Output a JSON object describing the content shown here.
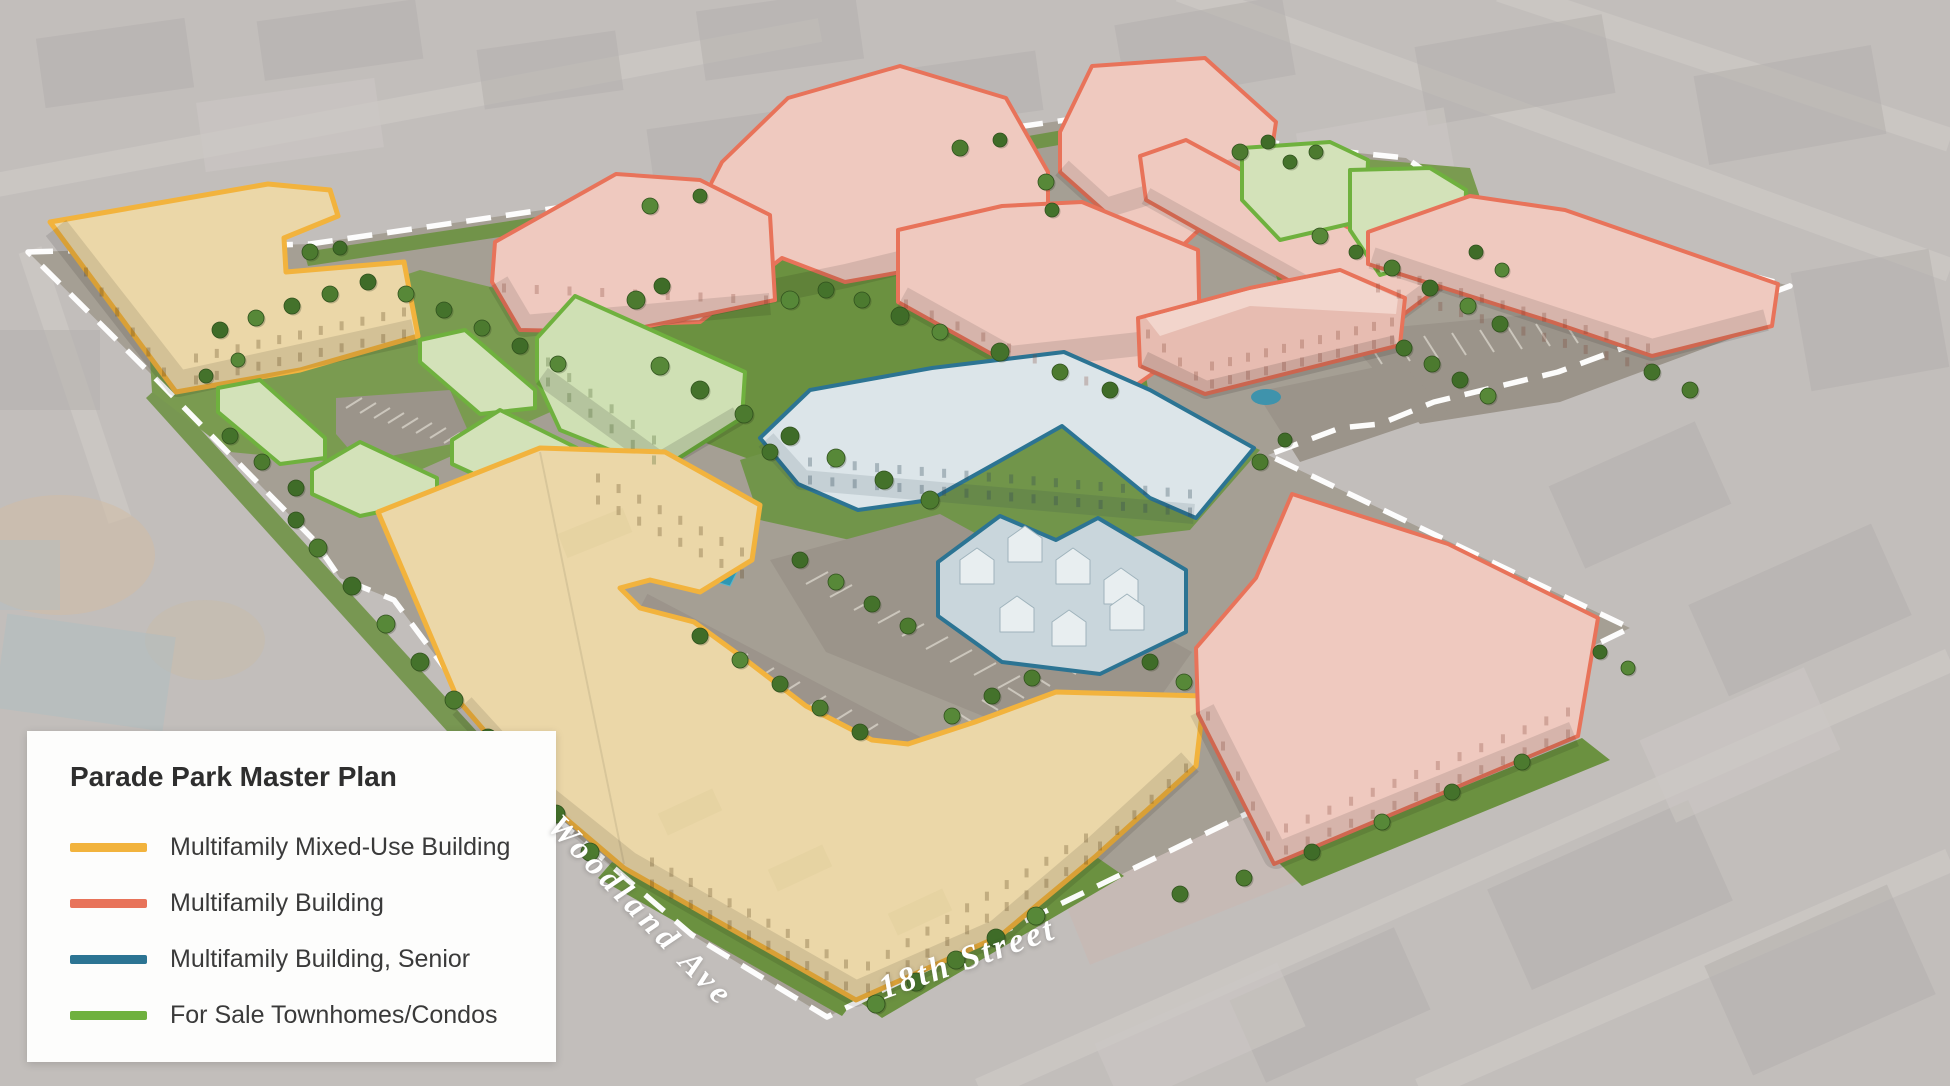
{
  "legend": {
    "title": "Parade Park Master Plan",
    "items": [
      {
        "id": "mixed_use",
        "label": "Multifamily Mixed-Use Building",
        "color": "#F2B33D"
      },
      {
        "id": "multifamily",
        "label": "Multifamily Building",
        "color": "#E8735A"
      },
      {
        "id": "senior",
        "label": "Multifamily Building, Senior",
        "color": "#2C7493"
      },
      {
        "id": "townhomes",
        "label": "For Sale Townhomes/Condos",
        "color": "#6FB13E"
      }
    ]
  },
  "streets": {
    "woodland": "Woodland Ave",
    "eighteenth": "18th Street"
  },
  "site": {
    "boundary_color": "#FFFFFF"
  }
}
